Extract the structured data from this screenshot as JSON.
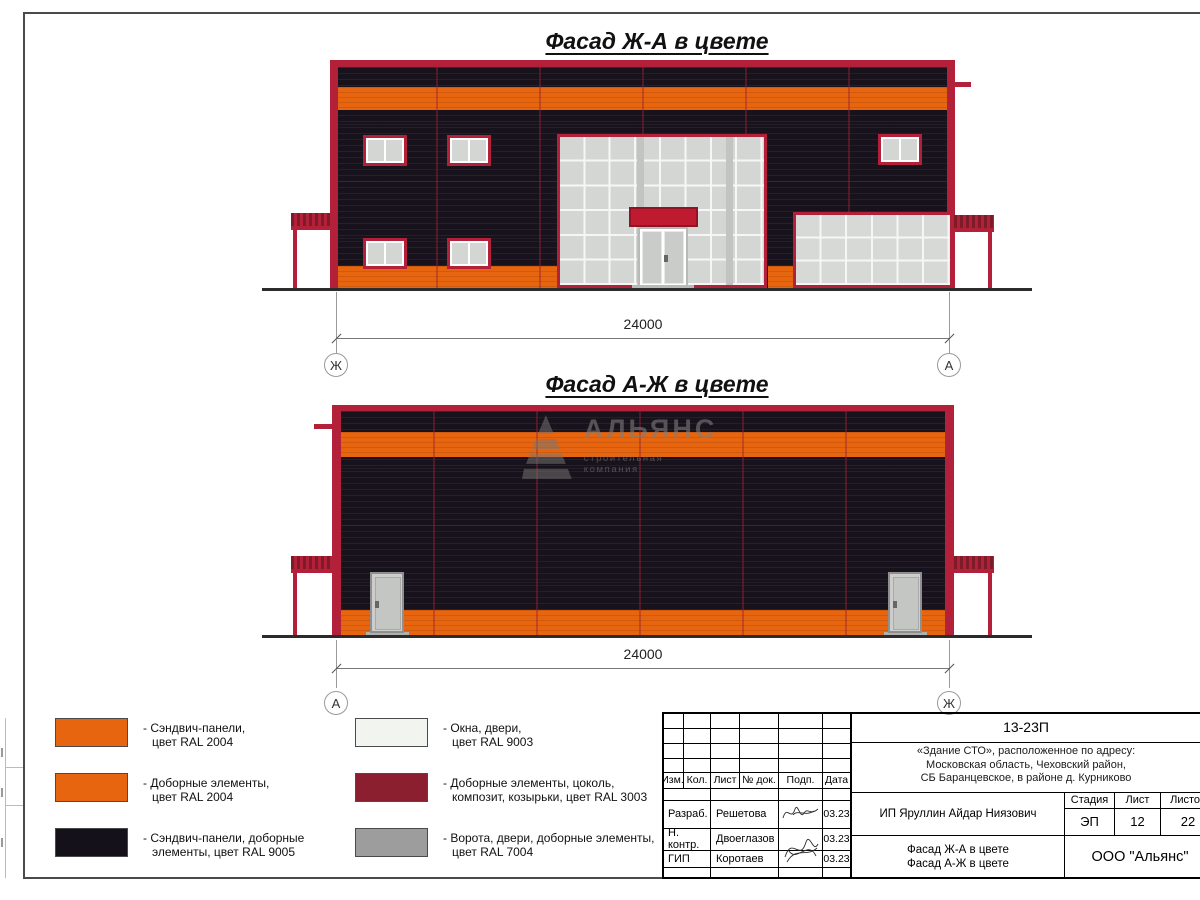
{
  "titles": {
    "facade1": "Фасад Ж-А в цвете",
    "facade2": "Фасад А-Ж в цвете"
  },
  "dimensions": {
    "facade1": {
      "value": "24000",
      "axis_left": "Ж",
      "axis_right": "А"
    },
    "facade2": {
      "value": "24000",
      "axis_left": "А",
      "axis_right": "Ж"
    }
  },
  "watermark": {
    "name": "АЛЬЯНС",
    "subtitle": "строительная компания"
  },
  "legend": {
    "items": [
      {
        "line1": "- Сэндвич-панели,",
        "line2": "цвет RAL 2004",
        "color": "#E8650F"
      },
      {
        "line1": "- Доборные элементы,",
        "line2": "цвет RAL 2004",
        "color": "#E8650F"
      },
      {
        "line1": "- Сэндвич-панели, доборные",
        "line2": "элементы, цвет RAL 9005",
        "color": "#15111A"
      },
      {
        "line1": "- Окна, двери,",
        "line2": "цвет RAL 9003",
        "color": "#F2F4EF"
      },
      {
        "line1": "- Доборные элементы, цоколь,",
        "line2": "композит, козырьки, цвет RAL 3003",
        "color": "#8C1F2F"
      },
      {
        "line1": "- Ворота, двери, доборные элементы,",
        "line2": "цвет RAL 7004",
        "color": "#9D9D9D"
      }
    ]
  },
  "titleblock": {
    "doc_number": "13-23П",
    "project_line1": "«Здание СТО», расположенное по адресу:",
    "project_line2": "Московская область, Чеховский район,",
    "project_line3": "СБ Баранцевское, в районе д. Курниково",
    "client": "ИП Яруллин Айдар Ниязович",
    "headers": {
      "izm": "Изм.",
      "kol": "Кол.",
      "list": "Лист",
      "doc": "№ док.",
      "podp": "Подп.",
      "data": "Дата"
    },
    "rows": [
      {
        "role": "Разраб.",
        "name": "Решетова",
        "date": "03.23"
      },
      {
        "role": "Н. контр.",
        "name": "Двоеглазов",
        "date": "03.23"
      },
      {
        "role": "ГИП",
        "name": "Коротаев",
        "date": "03.23"
      }
    ],
    "stage_label": "Стадия",
    "sheet_label": "Лист",
    "sheets_label": "Листов",
    "stage": "ЭП",
    "sheet": "12",
    "sheets": "22",
    "sheet_title_line1": "Фасад Ж-А в цвете",
    "sheet_title_line2": "Фасад А-Ж в цвете",
    "company": "ООО \"Альянс\""
  },
  "colors": {
    "orange": "#E8650F",
    "panel_black": "#17121B",
    "crimson": "#B2203A",
    "canopy_red": "#C01A31",
    "ruby": "#8C1F2F",
    "glass": "#D4D6D4",
    "gray_gate": "#9D9D9D",
    "white_window": "#F2F4EF",
    "ground": "#2B2B2B"
  }
}
